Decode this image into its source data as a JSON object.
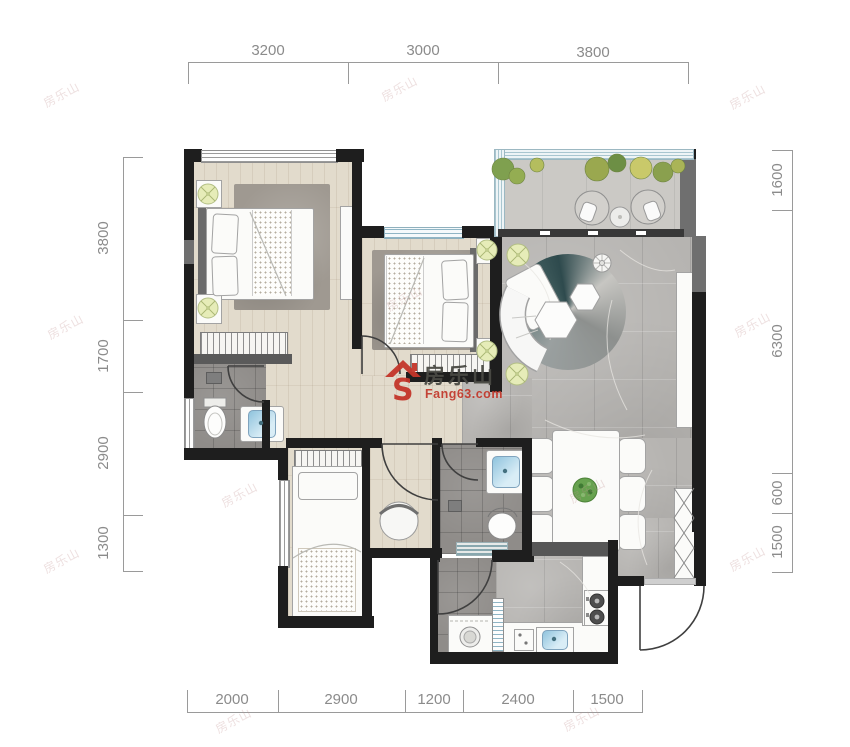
{
  "watermark": {
    "brand": "房乐山",
    "site": "Fang63.com"
  },
  "tiled_watermark": "房乐山",
  "dims": {
    "top": [
      "3200",
      "3000",
      "3800"
    ],
    "bottom": [
      "2000",
      "2900",
      "1200",
      "2400",
      "1500"
    ],
    "left": [
      "3800",
      "1700",
      "2900",
      "1300"
    ],
    "right": [
      "1600",
      "6300",
      "600",
      "1500"
    ]
  },
  "colors": {
    "wall": "#1e1e1e",
    "wall_gray": "#6f6f6f",
    "wood_floor": "#e2dbcc",
    "marble_floor": "#b6b4b1",
    "bath_tile": "#8f8c89",
    "balcony_floor": "#cbc9c5",
    "sink_blue": "#8fc3dd",
    "logo_red": "#c4362a",
    "dim_text": "#8b8b8b"
  }
}
